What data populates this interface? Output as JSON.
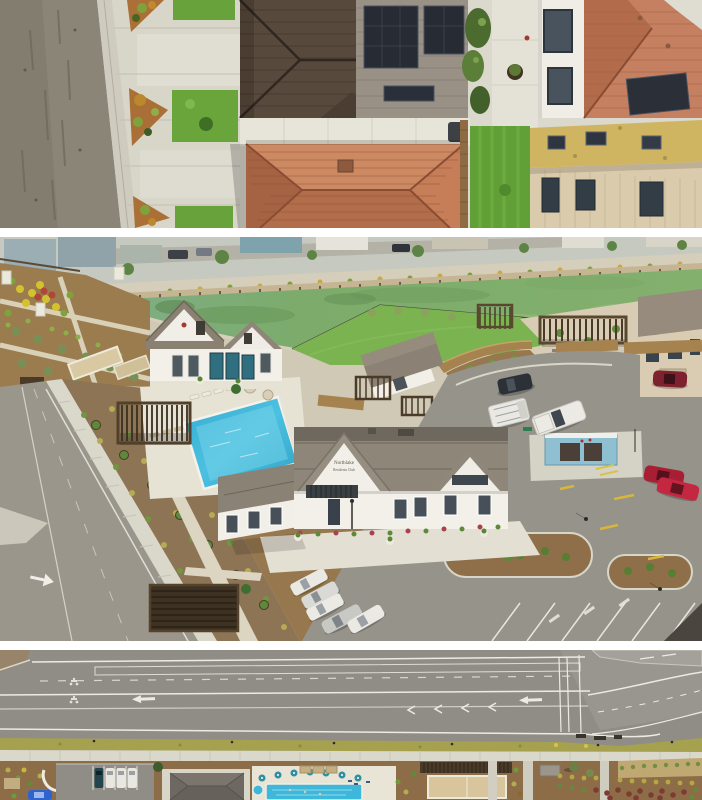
{
  "page": {
    "background": "#ffffff"
  },
  "gallery": {
    "photos": [
      {
        "name": "aerial-rooftops-photo",
        "alt": "Overhead drone view of home rooftops, solar panels, driveways and street"
      },
      {
        "name": "amenity-center-photo",
        "alt": "Drone view of community clubhouse, pool, gardens, lake and parking lot",
        "sign": {
          "line1": "Northlake",
          "line2": "Residents Club"
        }
      },
      {
        "name": "boulevard-photo",
        "alt": "Overhead drone view of boulevard lane striping and amenity grounds"
      }
    ]
  },
  "palette": {
    "asphalt": "#908d83",
    "concrete": "#d9d6ca",
    "mulch": "#8d6f4b",
    "lawn": "#7cb351",
    "pond_green": "#7fae6e",
    "pool_blue": "#3fb7da",
    "roof_dark_brown": "#57493c",
    "roof_tile_orange": "#c17c59",
    "roof_gray": "#8e8679",
    "wall_white": "#f2f0e9",
    "door_teal": "#2f6f80",
    "car_red": "#b02136",
    "shrub_green": "#6f9a3c",
    "shrub_yellow": "#b3a84e",
    "marking_white": "#eceae2",
    "yellow_roof": "#cfb561"
  }
}
